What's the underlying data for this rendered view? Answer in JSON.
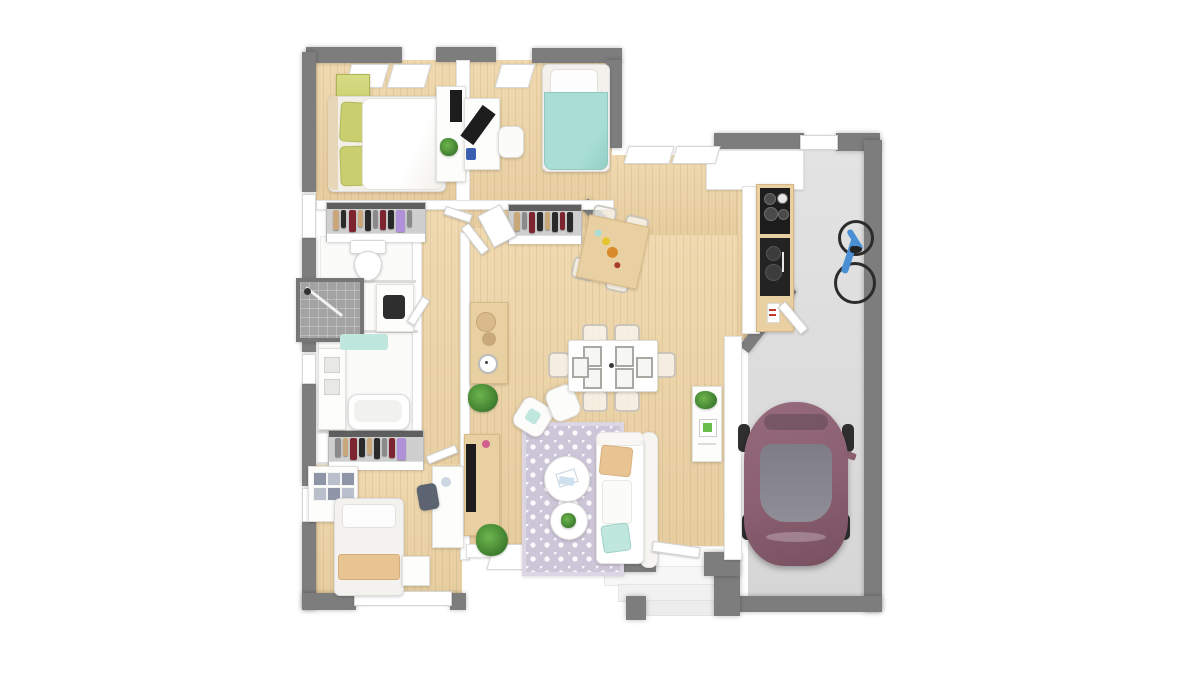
{
  "scene": {
    "type": "3d-floor-plan-top-down-render",
    "description": "Photoreal top view of a single-storey house plan with three bedrooms, bathroom, WC, open living-dining-kitchen and an attached garage with a parked car and a wall-hung bicycle",
    "background": "#ffffff"
  },
  "palette": {
    "wall_dark": "#7d7d7d",
    "wall_white": "#ffffff",
    "wood_floor": "#eed4a5",
    "wood_furn": "#e9d0a2",
    "garage_floor": "#dadada",
    "rug": "#ccc6d8",
    "teal": "#a9ded6",
    "teal_light": "#bfe7dd",
    "green_olive": "#c9cf6f",
    "plant_green": "#3f7e2e",
    "beige": "#e9c493",
    "car_body": "#8a5f70",
    "car_glass": "#8f8e96",
    "bike_blue": "#4a8fd4",
    "appliance_dark": "#1d1d1d",
    "clothes_1": "#c8a878",
    "clothes_2": "#7d2430",
    "clothes_3": "#2a2a2a",
    "clothes_4": "#b090d8",
    "clothes_5": "#8a8a8a"
  },
  "rooms": [
    {
      "name": "master-bedroom",
      "furniture": [
        "double-bed-white-duvet",
        "green-pillows",
        "green-dresser",
        "desk-with-monitor",
        "wardrobe-with-clothes"
      ]
    },
    {
      "name": "bedroom-2",
      "furniture": [
        "single-bed-teal-duvet",
        "desk-with-monitor",
        "desk-chair",
        "wardrobe-with-clothes"
      ]
    },
    {
      "name": "bedroom-3",
      "furniture": [
        "single-bed-beige-blanket",
        "wall-shelf-unit",
        "nightstand",
        "desk",
        "chair",
        "wardrobe-with-clothes"
      ]
    },
    {
      "name": "wc",
      "furniture": [
        "toilet"
      ]
    },
    {
      "name": "bathroom",
      "furniture": [
        "shower",
        "washing-machine",
        "vanity",
        "bathtub",
        "teal-bath-mat"
      ]
    },
    {
      "name": "hallway",
      "furniture": [
        "console-table",
        "clock",
        "potted-plant"
      ]
    },
    {
      "name": "living-room",
      "furniture": [
        "l-shaped-sofa",
        "beige-cushion",
        "teal-cushion",
        "two-armchairs",
        "patterned-rug",
        "round-coffee-tables",
        "tv-console",
        "tv",
        "potted-plant"
      ]
    },
    {
      "name": "dining-area",
      "furniture": [
        "dining-table",
        "six-ghost-chairs",
        "six-place-settings",
        "sideboard",
        "plant"
      ]
    },
    {
      "name": "kitchen",
      "furniture": [
        "counter-column",
        "cooktop",
        "sink",
        "breakfast-table",
        "four-ghost-chairs"
      ]
    },
    {
      "name": "garage",
      "furniture": [
        "plum-car",
        "blue-bicycle-on-wall"
      ]
    },
    {
      "name": "entry-porch",
      "furniture": [
        "steps"
      ]
    }
  ],
  "counts": {
    "dining_seats": 6,
    "dining_place_settings": 6,
    "kitchen_table_seats": 4,
    "wardrobes": 3,
    "bedrooms": 3
  }
}
